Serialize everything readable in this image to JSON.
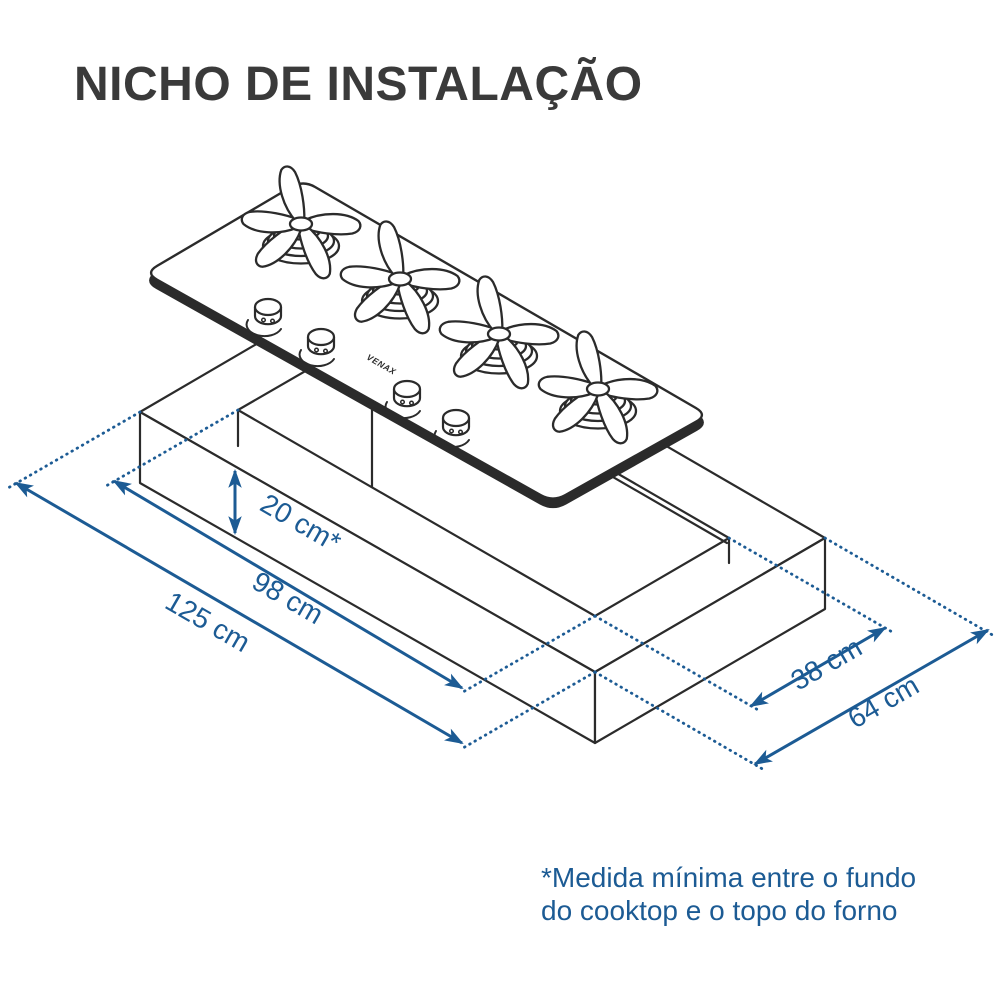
{
  "title": "NICHO DE INSTALAÇÃO",
  "colors": {
    "dimension_blue": "#1c5b94",
    "line_dark": "#2b2b2b",
    "title_gray": "#3a3a3a",
    "background": "#ffffff"
  },
  "diagram": {
    "description": "isometric-installation-niche-drawing",
    "brand": "VENAX",
    "burner_count": "4",
    "dimensions": {
      "clearance": "20 cm*",
      "cutout_length": "98 cm",
      "countertop_length": "125 cm",
      "cutout_width": "38 cm",
      "countertop_width": "64 cm"
    }
  },
  "footnote": {
    "line1": "*Medida mínima entre o fundo",
    "line2": "do cooktop e o topo do forno"
  }
}
